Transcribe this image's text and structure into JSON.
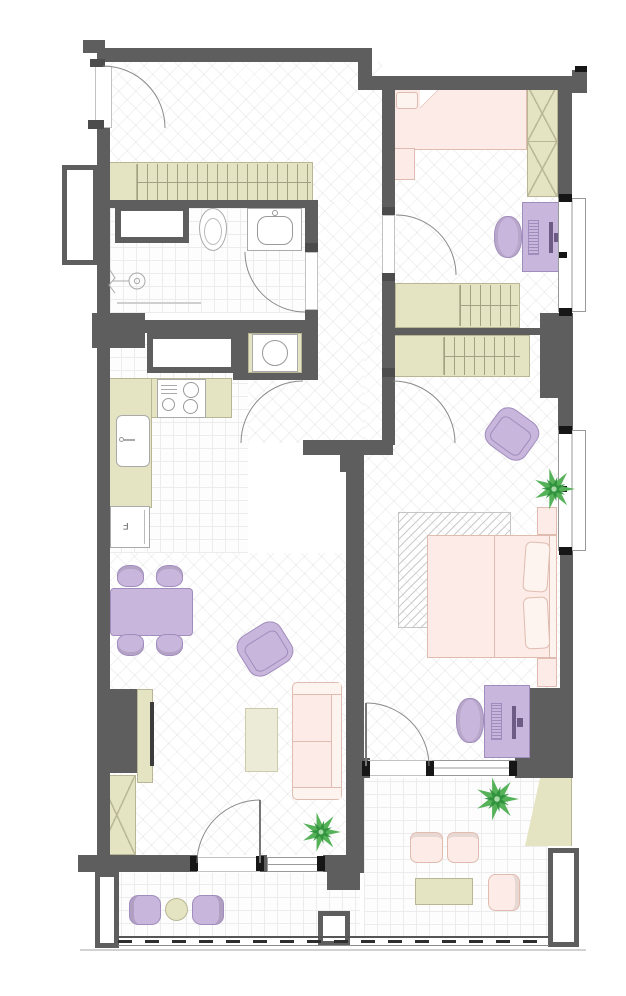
{
  "document": {
    "type": "residential apartment floor plan, top-down 2D view",
    "visible_text": [
      "F"
    ]
  },
  "labels": {
    "fridge": "F"
  },
  "colors": {
    "wall": "#5e5e5e",
    "tick": "#161616",
    "pink": "#fcebe6",
    "pinkB": "#e0bcb0",
    "pinkSoft": "#fdf3ef",
    "purple": "#c9b6dc",
    "purpleB": "#a18dbd",
    "olive": "#e5e4c2",
    "oliveB": "#b8b694",
    "creme": "#ecebd8",
    "cremeB": "#cdcbaa",
    "green": "#56b259",
    "greenD": "#2f8f3c",
    "arc": "#8a8a8a"
  },
  "icons": {
    "door-swing": "quarter-arc",
    "plant": "star-leaf-cluster",
    "hanger-rail": "vertical-stripes-on-rail",
    "cabinet-x": "crossed-diagonals",
    "window": "double-line-with-black-stops"
  },
  "rooms": [
    {
      "name": "entry-hall",
      "furniture": [
        "entry-door",
        "coat-wardrobe-with-hangers"
      ]
    },
    {
      "name": "bathroom",
      "furniture": [
        "duct-box",
        "toilet",
        "washbasin-vanity",
        "shower-head",
        "shower-screen"
      ]
    },
    {
      "name": "utility-niche",
      "furniture": [
        "washing-machine"
      ]
    },
    {
      "name": "kitchen",
      "furniture": [
        "island-cabinet",
        "four-burner-stove",
        "counter",
        "sink",
        "refrigerator"
      ]
    },
    {
      "name": "kids-bedroom",
      "furniture": [
        "single-bed",
        "tall-x-wardrobe",
        "desk",
        "desk-chair",
        "wardrobe-with-hangers"
      ]
    },
    {
      "name": "master-bedroom",
      "furniture": [
        "wardrobe-with-hangers",
        "armchair",
        "plant",
        "nightstand",
        "double-bed",
        "rug",
        "nightstand",
        "desk",
        "desk-chair"
      ]
    },
    {
      "name": "living-dining-room",
      "furniture": [
        "dining-table",
        "dining-chair",
        "dining-chair",
        "dining-chair",
        "dining-chair",
        "tv-stand",
        "tv",
        "x-cabinet",
        "armchair",
        "coffee-table",
        "sofa",
        "plant"
      ]
    },
    {
      "name": "balcony-left",
      "furniture": [
        "armchair",
        "round-table",
        "armchair",
        "railing",
        "columns"
      ]
    },
    {
      "name": "balcony-right",
      "furniture": [
        "plant",
        "armchair",
        "armchair",
        "table",
        "chair",
        "console"
      ]
    }
  ]
}
